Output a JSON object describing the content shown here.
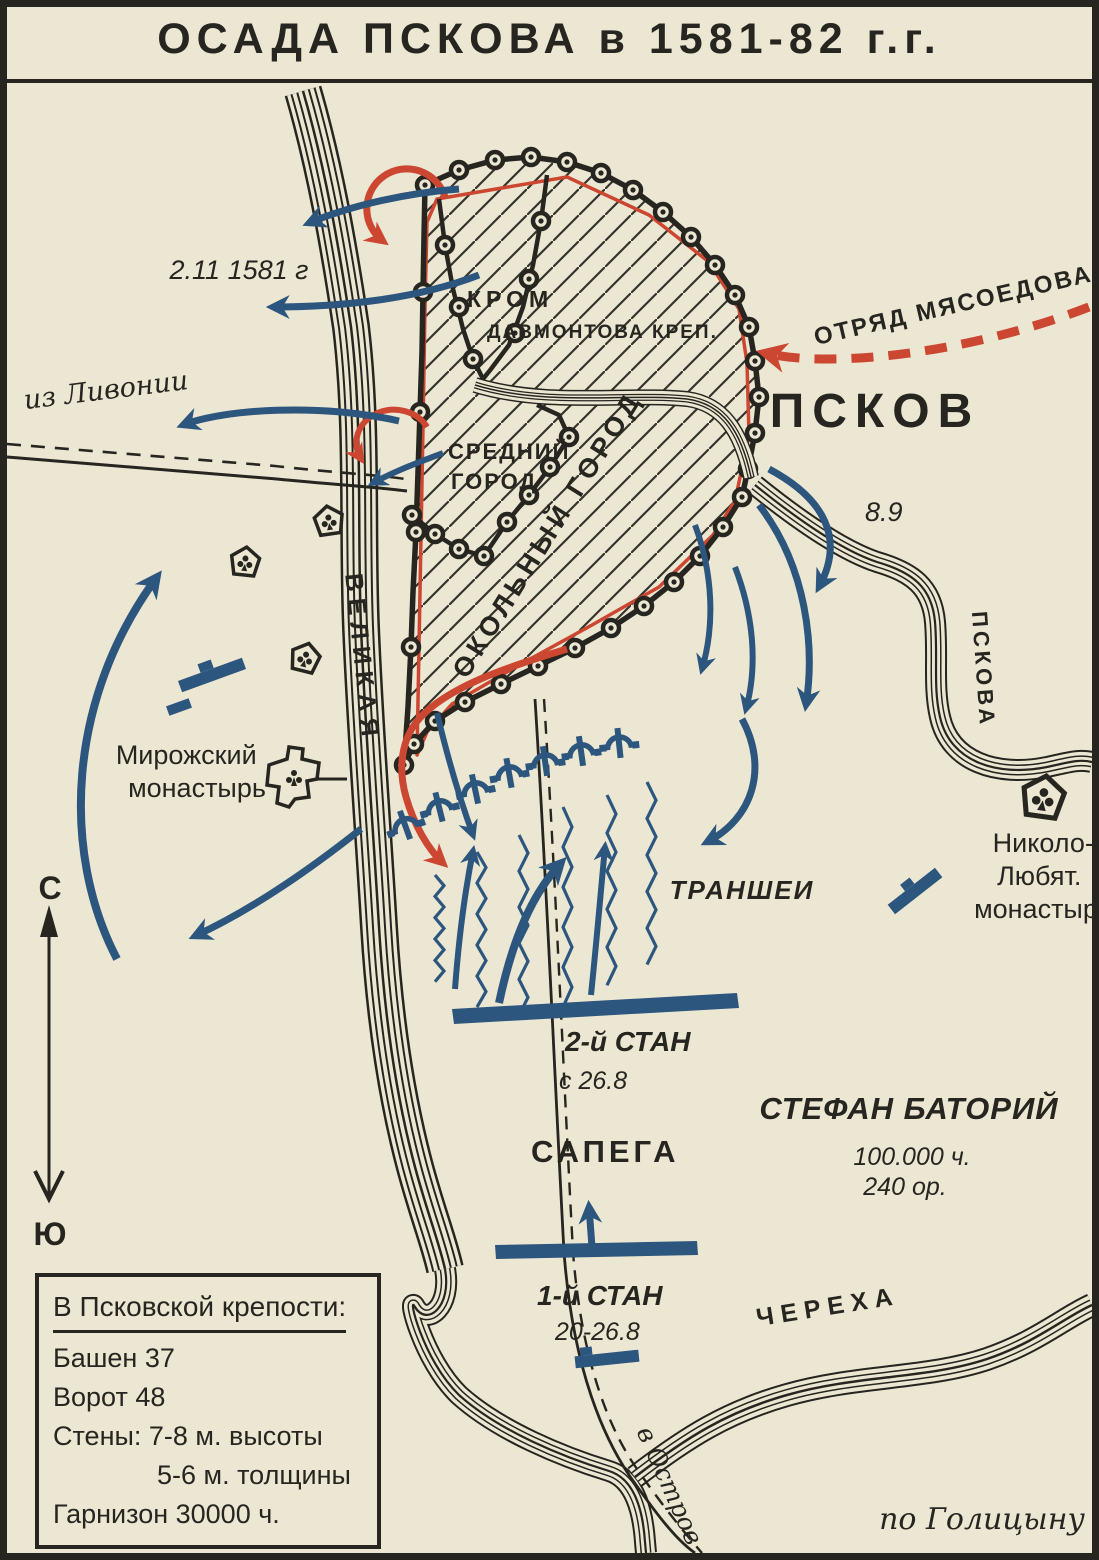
{
  "title": "ОСАДА ПСКОВА  в  1581-82 г.г.",
  "colors": {
    "paper": "#ece7d3",
    "ink": "#26251f",
    "blue": "#2d567e",
    "red": "#cc4731"
  },
  "compass": {
    "north": "С",
    "south": "Ю"
  },
  "fortress": {
    "krom": "КРОМ",
    "dovmont": "ДАВМОНТОВА КРЕП.",
    "sredny": [
      "СРЕДНИЙ",
      "ГОРОД"
    ],
    "okolny": "ОКОЛЬНЫЙ ГОРОД"
  },
  "labels": {
    "pskov": "ПСКОВ",
    "myasoedov": "ОТРЯД МЯСОЕДОВА",
    "sortie_date": "2.11 1581 г",
    "assault_date": "8.9",
    "livonia": "из Ливонии",
    "velikaya": "ВЕЛИКАЯ",
    "pskova": "ПСКОВА",
    "cherekha": "ЧЕРЕХА",
    "mirozhsky": [
      "Мирожский",
      "монастырь"
    ],
    "nikolo": [
      "Николо-",
      "Любят.",
      "монастырь"
    ],
    "trenches": "ТРАНШЕИ",
    "camp2": "2-й СТАН",
    "camp2_date": "с 26.8",
    "sapega": "САПЕГА",
    "batory": "СТЕФАН БАТОРИЙ",
    "batory_men": "100.000 ч.",
    "batory_guns": "240 ор.",
    "camp1": "1-й СТАН",
    "camp1_date": "20-26.8",
    "ostrov": "в Остров",
    "source": "по Голицыну"
  },
  "info_box": {
    "title": "В Псковской крепости:",
    "lines": [
      "Башен 37",
      "Ворот 48",
      "Стены: 7-8 м. высоты",
      "5-6 м. толщины",
      "Гарнизон 30000 ч."
    ]
  }
}
